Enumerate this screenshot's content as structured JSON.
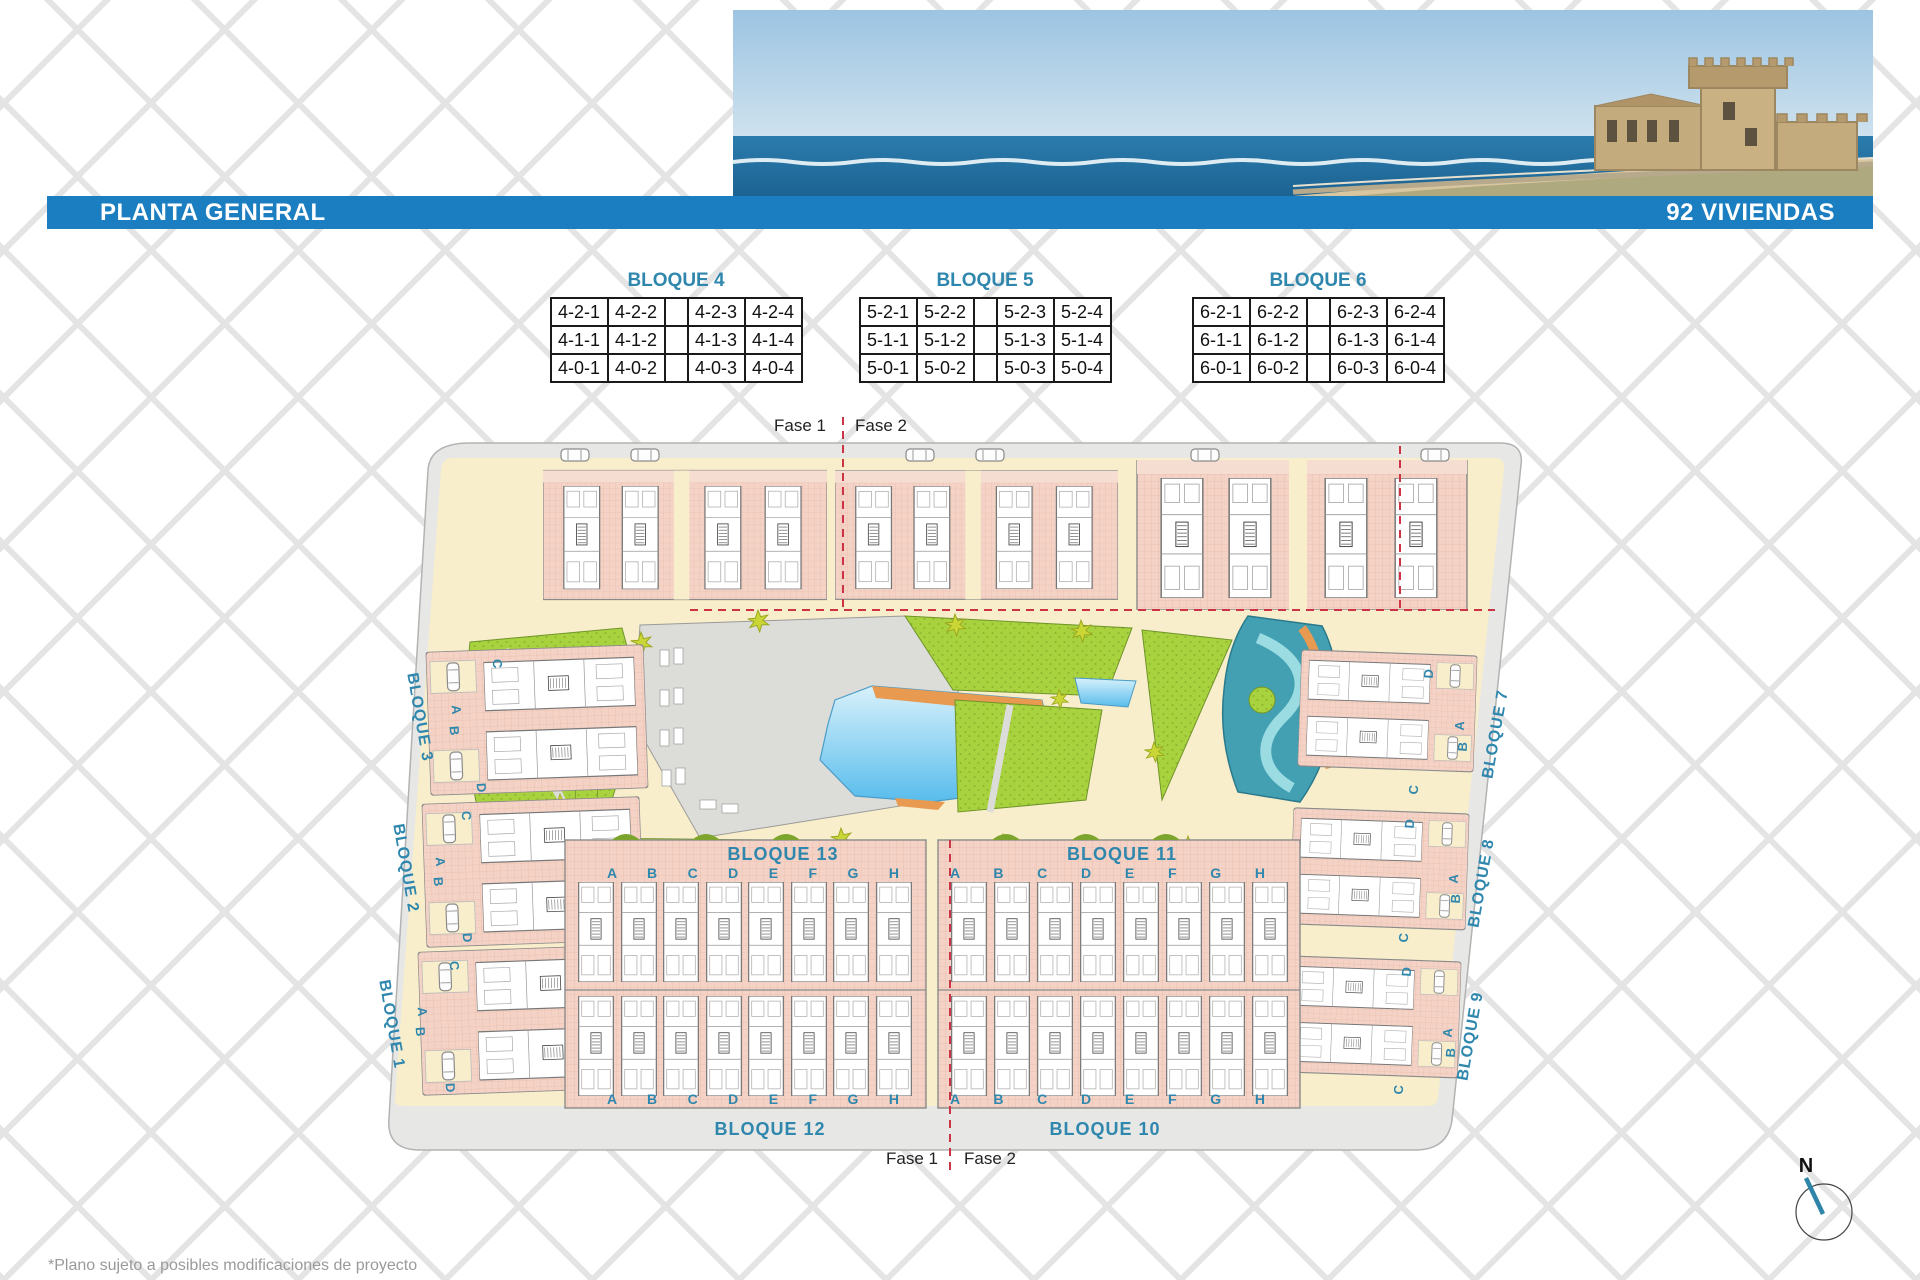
{
  "header": {
    "title": "PLANTA GENERAL",
    "badge": "92 VIVIENDAS"
  },
  "unit_tables": [
    {
      "title": "BLOQUE 4",
      "rows": [
        [
          "4-2-1",
          "4-2-2",
          "",
          "4-2-3",
          "4-2-4"
        ],
        [
          "4-1-1",
          "4-1-2",
          "",
          "4-1-3",
          "4-1-4"
        ],
        [
          "4-0-1",
          "4-0-2",
          "",
          "4-0-3",
          "4-0-4"
        ]
      ]
    },
    {
      "title": "BLOQUE 5",
      "rows": [
        [
          "5-2-1",
          "5-2-2",
          "",
          "5-2-3",
          "5-2-4"
        ],
        [
          "5-1-1",
          "5-1-2",
          "",
          "5-1-3",
          "5-1-4"
        ],
        [
          "5-0-1",
          "5-0-2",
          "",
          "5-0-3",
          "5-0-4"
        ]
      ]
    },
    {
      "title": "BLOQUE 6",
      "rows": [
        [
          "6-2-1",
          "6-2-2",
          "",
          "6-2-3",
          "6-2-4"
        ],
        [
          "6-1-1",
          "6-1-2",
          "",
          "6-1-3",
          "6-1-4"
        ],
        [
          "6-0-1",
          "6-0-2",
          "",
          "6-0-3",
          "6-0-4"
        ]
      ]
    }
  ],
  "plan": {
    "phase_top": {
      "left": "Fase 1",
      "right": "Fase 2"
    },
    "phase_bottom": {
      "left": "Fase 1",
      "right": "Fase 2"
    },
    "left_blocks": [
      {
        "label": "BLOQUE 3",
        "letters": {
          "top": "C",
          "mid_a": "A",
          "mid_b": "B",
          "bottom": "D"
        }
      },
      {
        "label": "BLOQUE 2",
        "letters": {
          "top": "C",
          "mid_a": "A",
          "mid_b": "B",
          "bottom": "D"
        }
      },
      {
        "label": "BLOQUE 1",
        "letters": {
          "top": "C",
          "mid_a": "A",
          "mid_b": "B",
          "bottom": "D"
        }
      }
    ],
    "right_blocks": [
      {
        "label": "BLOQUE 7",
        "letters": {
          "top": "D",
          "mid_a": "A",
          "mid_b": "B",
          "bottom": "C"
        }
      },
      {
        "label": "BLOQUE 8",
        "letters": {
          "top": "D",
          "mid_a": "A",
          "mid_b": "B",
          "bottom": "C"
        }
      },
      {
        "label": "BLOQUE 9",
        "letters": {
          "top": "D",
          "mid_a": "A",
          "mid_b": "B",
          "bottom": "C"
        }
      }
    ],
    "center_blocks": [
      {
        "label": "BLOQUE 13",
        "letters_row": "A B C D E F G H"
      },
      {
        "label": "BLOQUE 11",
        "letters_row": "A B C D E F G H"
      }
    ],
    "bottom_road_labels": [
      {
        "label": "BLOQUE 12"
      },
      {
        "label": "BLOQUE 10"
      }
    ]
  },
  "compass": {
    "label": "N"
  },
  "footer": {
    "note": "*Plano sujeto a posibles modificaciones de proyecto"
  },
  "colors": {
    "bar_blue": "#1b7ec1",
    "label_blue": "#2f87ad",
    "salmon": "#f4d3c6",
    "green": "#a9d23f",
    "pool_blue": "#58bcec",
    "river_teal": "#42a0b2",
    "slide_orange": "#e89a50",
    "phase_red": "#cc3344",
    "ground_cream": "#f9eecb",
    "road_gray": "#e7e7e5"
  }
}
